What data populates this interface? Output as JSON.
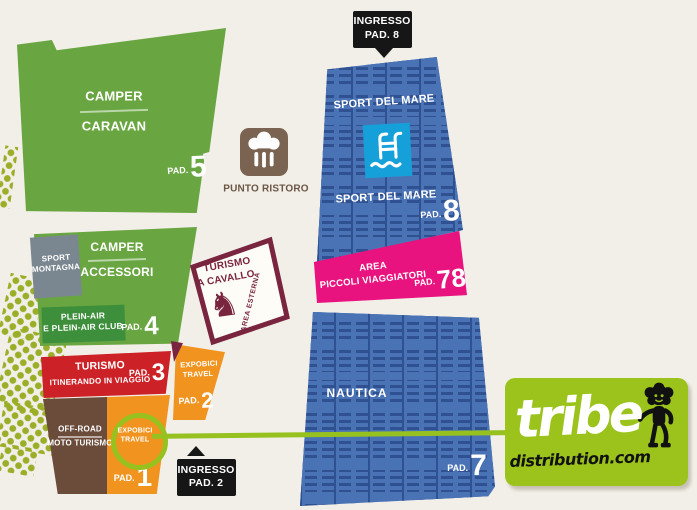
{
  "map": {
    "entrance_top": {
      "line1": "INGRESSO",
      "line2": "PAD. 8"
    },
    "entrance_bottom": {
      "line1": "INGRESSO",
      "line2": "PAD. 2"
    },
    "punto_ristoro": {
      "label": "PUNTO RISTORO"
    },
    "pavilions": {
      "camper_caravan": {
        "line1": "CAMPER",
        "line2": "CARAVAN",
        "pad": "PAD.",
        "num": "5"
      },
      "sport_montagna": {
        "line1": "SPORT",
        "line2": "MONTAGNA"
      },
      "camper_accessori": {
        "line1": "CAMPER",
        "line2": "ACCESSORI"
      },
      "plein_air": {
        "line1": "PLEIN-AIR",
        "line2": "E PLEIN-AIR CLUB",
        "pad": "PAD.",
        "num": "4"
      },
      "turismo_itinerante": {
        "line1": "TURISMO",
        "line2": "ITINERANDO IN VIAGGIO",
        "pad": "PAD.",
        "num": "3"
      },
      "expobici_travel_2": {
        "line1": "EXPOBICI",
        "line2": "TRAVEL",
        "pad": "PAD.",
        "num": "2"
      },
      "off_road": {
        "line1": "OFF-ROAD",
        "line2": "MOTO TURISMO"
      },
      "expobici_travel_1": {
        "line1": "EXPOBICI",
        "line2": "TRAVEL",
        "pad": "PAD.",
        "num": "1"
      },
      "turismo_a_cavallo": {
        "line1": "TURISMO",
        "line2": "A CAVALLO",
        "area": "AREA ESTERNA",
        "horse_glyph": "♞"
      },
      "sport_del_mare": {
        "label_top": "SPORT DEL MARE",
        "label_bottom": "SPORT DEL MARE",
        "pad": "PAD.",
        "num": "8"
      },
      "area_piccoli_viaggiatori": {
        "line1": "AREA",
        "line2": "PICCOLI VIAGGIATORI",
        "pad": "PAD.",
        "num": "78"
      },
      "nautica": {
        "label": "NAUTICA",
        "pad": "PAD.",
        "num": "7"
      }
    },
    "logo": {
      "brand": "tribe",
      "domain": "distribution.com"
    },
    "colors": {
      "green": "#69a540",
      "dark_green": "#3d8f3c",
      "gray": "#7b8790",
      "red": "#cc2127",
      "orange": "#f0941f",
      "brown": "#6b4c3b",
      "ristoro_brown": "#7a6350",
      "blue": "#4a73b5",
      "pool_blue": "#16a0da",
      "pink": "#e9137f",
      "maroon": "#7a2540",
      "lime": "#96c11e",
      "black": "#161616",
      "background": "#f2efe8"
    }
  }
}
